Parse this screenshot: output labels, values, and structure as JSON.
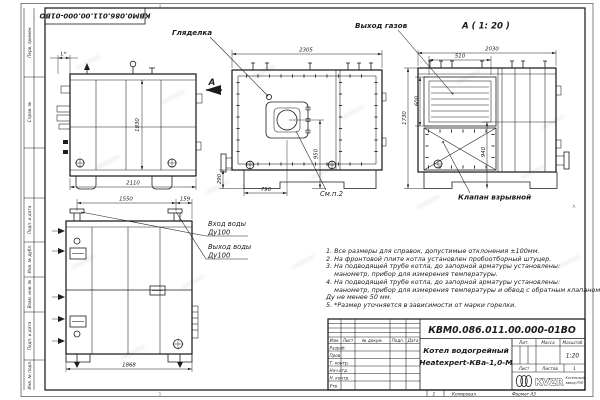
{
  "colors": {
    "ink": "#1c1c1c",
    "paper": "#ffffff"
  },
  "stamp": {
    "designation_rotated": "КВМ0.086.011.00.000-01ВО"
  },
  "zones": {
    "top": "1",
    "bottom": "1",
    "right": "А"
  },
  "margin_fields": {
    "f1": "Перв. примен.",
    "f2": "Справ. №",
    "f3": "Подп. и дата",
    "f4": "Инв. № дубл.",
    "f5": "Взам. инв. №",
    "f6": "Подп. и дата",
    "f7": "Инв. № подл."
  },
  "views": {
    "side": {
      "view_arrow": "А",
      "dim_burner": "L*",
      "dim_height": "1830",
      "dim_length": "2110"
    },
    "front": {
      "label_peephole": "Гляделка",
      "label_see_item": "См.п.2",
      "dim_width": "2305",
      "dim_base": "290",
      "dim_axis": "950",
      "dim_front": "790"
    },
    "view_a": {
      "title": "А ( 1: 20 )",
      "label_gas": "Выход газов",
      "label_valve": "Клапан взрывной",
      "dim_width": "2030",
      "dim_flue_w": "510",
      "dim_flue_h": "600",
      "dim_height": "1730",
      "dim_lower": "940"
    },
    "rear": {
      "dim_span": "1550",
      "dim_offset": "159",
      "dim_width": "1868",
      "inlet": "Вход воды",
      "inlet_dn": "Ду100",
      "outlet": "Выход воды",
      "outlet_dn": "Ду100"
    }
  },
  "notes": {
    "text": "1. Все размеры для справок, допустимые отклонения ±100мм.\n2. На фронтовой плите котла установлен пробоотборный штуцер.\n3. На подводящей трубе котла, до запорной арматуры установлены:\n    манометр, прибор для измерения температуры.\n4. На подводящей трубе котла, до запорной арматуры установлены:\n    манометр, прибор для измерения температуры и обвод с обратным клапаном\nДу не менее 50 мм.\n5. *Размер уточняется в зависимости от марки горелки."
  },
  "title_block": {
    "designation": "КВМ0.086.011.00.000-01ВО",
    "name1": "Котел водогрейный",
    "name2": "Heatexpert-КВа-1,0-М",
    "col_izm": "Изм.",
    "col_list": "Лист",
    "col_doc": "№ докум.",
    "col_podp": "Подп.",
    "col_data": "Дата",
    "row1": "Разраб.",
    "row2": "Пров.",
    "row3": "Т. контр.",
    "row4": "Нач.отд.",
    "row5": "Н. контр.",
    "row6": "Утв.",
    "lit": "Лит.",
    "mass": "Масса",
    "scale_label": "Масштаб",
    "scale": "1:20",
    "sheet": "Лист",
    "sheets": "Листов",
    "sheets_value": "1",
    "logo": "KVZR",
    "logo_sub1": "Котельный",
    "logo_sub2": "завод РЭП"
  },
  "footer": {
    "num": "1",
    "copied": "Копировал",
    "format": "Формат А3"
  }
}
